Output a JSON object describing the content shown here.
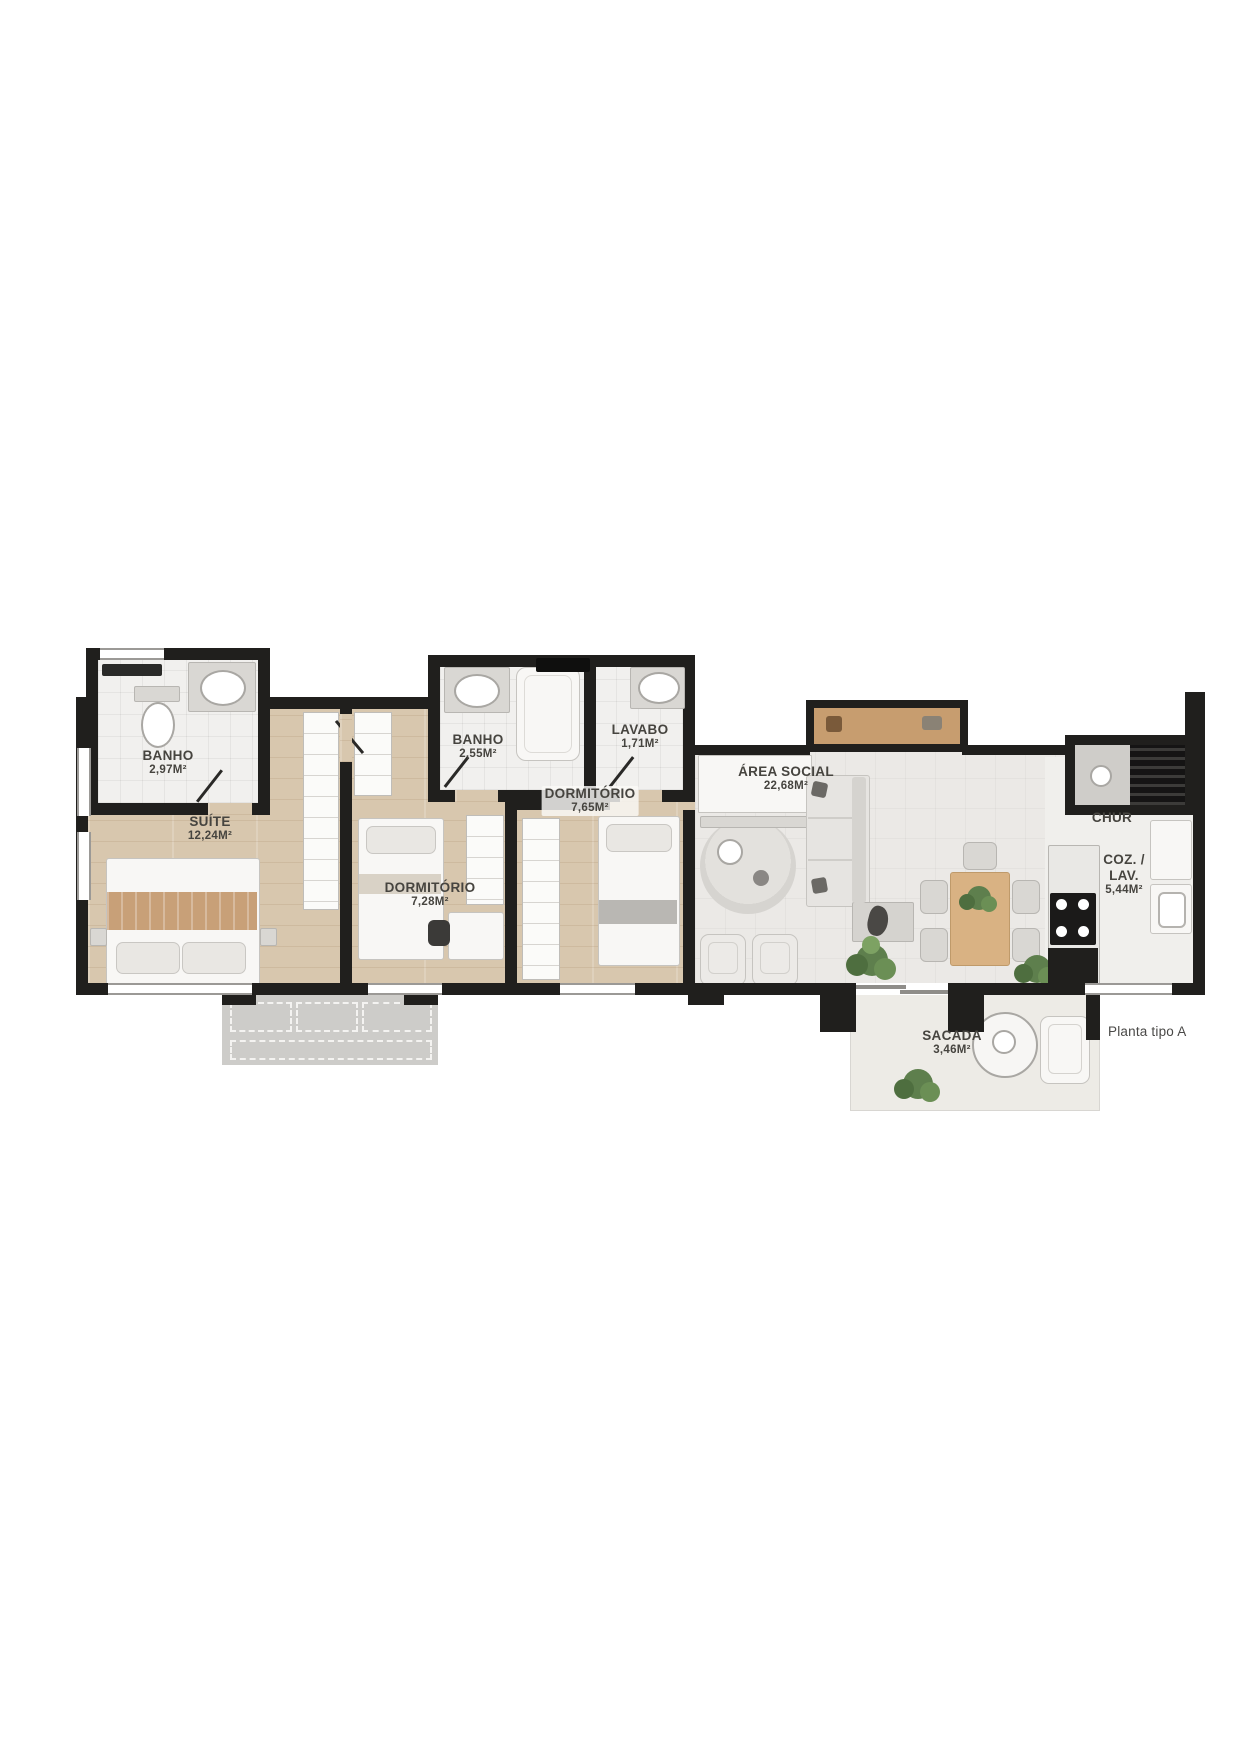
{
  "plan": {
    "footnote": "Planta tipo A",
    "rooms": {
      "banho_suite": {
        "name": "BANHO",
        "area": "2,97M²"
      },
      "suite": {
        "name": "SUÍTE",
        "area": "12,24M²"
      },
      "banho_social": {
        "name": "BANHO",
        "area": "2,55M²"
      },
      "lavabo": {
        "name": "LAVABO",
        "area": "1,71M²"
      },
      "dormitorio_1": {
        "name": "DORMITÓRIO",
        "area": "7,28M²"
      },
      "dormitorio_2": {
        "name": "DORMITÓRIO",
        "area": "7,65M²"
      },
      "area_social": {
        "name": "ÁREA SOCIAL",
        "area": "22,68M²"
      },
      "churrasqueira": {
        "name": "CHUR"
      },
      "cozinha": {
        "line1": "COZ. /",
        "line2": "LAV.",
        "area": "5,44M²"
      },
      "sacada": {
        "name": "SACADA",
        "area": "3,46M²"
      }
    },
    "palette": {
      "wall": "#201f1d",
      "wood_floor": "#d8c7ae",
      "social_floor": "#ebe9e6",
      "shelf_wood": "#c79d6f",
      "table_wood": "#d9b283",
      "plant_green": "#5e7f4d"
    }
  }
}
